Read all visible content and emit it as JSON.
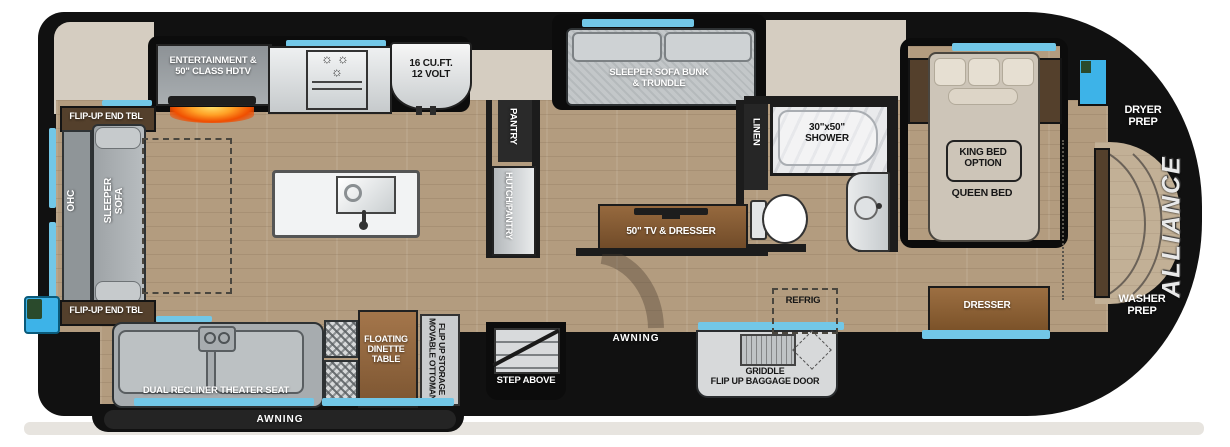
{
  "title": "Fifth wheel RV floor plan",
  "brand": "ALLIANCE",
  "colors": {
    "body_black": "#111111",
    "accent_blue": "#72c7e7",
    "beige": "#d5cdc1",
    "floor_wood": "#b39c7f",
    "furniture_wood": "#8a6240",
    "fireplace_orange": "#f04e00"
  },
  "areas": {
    "rear": {
      "flip_up_end_tbl_top": "FLIP-UP END TBL",
      "flip_up_end_tbl_bottom": "FLIP-UP END TBL",
      "ohc": "OHC",
      "sleeper_sofa": "SLEEPER\nSOFA"
    },
    "kitchen": {
      "entertainment": "ENTERTAINMENT &\n50\" CLASS HDTV",
      "refrigerator": "16 CU.FT.\n12 VOLT"
    },
    "living_slide": {
      "theater_seat": "DUAL RECLINER THEATER SEAT",
      "dinette": "FLOATING\nDINETTE\nTABLE",
      "movable_ottoman": "MOVABLE OTTOMAN\nFLIP UP STORAGE",
      "awning": "AWNING"
    },
    "mid": {
      "bunk": "SLEEPER SOFA BUNK\n& TRUNDLE",
      "pantry": "PANTRY",
      "hutch": "HUTCH/PANTRY",
      "tv_dresser": "50\" TV & DRESSER",
      "step": "STEP ABOVE",
      "awning": "AWNING",
      "refrig": "REFRIG",
      "griddle": "GRIDDLE\nFLIP UP BAGGAGE DOOR"
    },
    "bath": {
      "linen": "LINEN",
      "shower": "30\"x50\"\nSHOWER"
    },
    "bedroom": {
      "king_option": "KING BED\nOPTION",
      "queen_bed": "QUEEN BED",
      "dresser": "DRESSER"
    },
    "front": {
      "dryer_prep": "DRYER\nPREP",
      "washer_prep": "WASHER\nPREP",
      "brand": "ALLIANCE"
    }
  }
}
